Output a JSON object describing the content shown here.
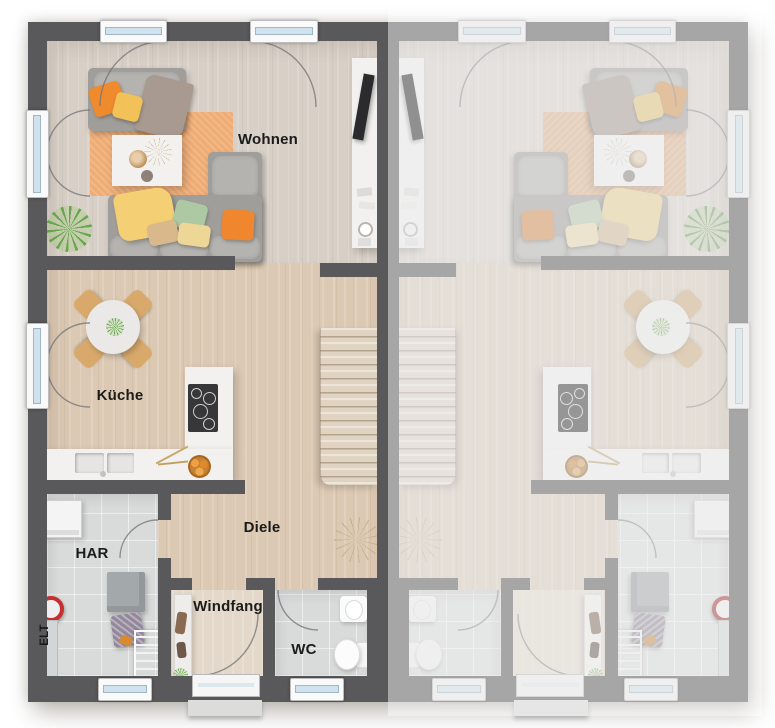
{
  "floorplan": {
    "labels": {
      "living": "Wohnen",
      "kitchen": "Küche",
      "hallway": "Diele",
      "utility": "HAR",
      "electrical": "ELT",
      "vestibule": "Windfang",
      "wc": "WC"
    },
    "colors": {
      "wall_dark": "#59595b",
      "wall_faded": "#a2a2a4",
      "floor_wood": "#dcc9b3",
      "floor_wood_living": "#d8d0c7",
      "floor_tile": "#d9dbdb",
      "rug_orange": "#efac75",
      "accent_orange": "#f0872e",
      "window_glass": "#cfe2ee"
    }
  }
}
